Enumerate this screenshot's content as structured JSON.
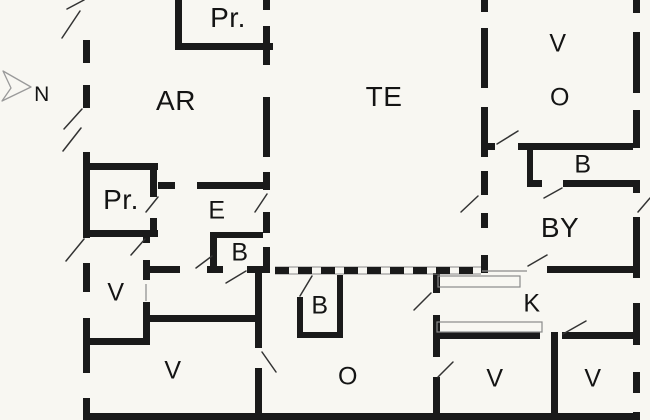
{
  "title": "Floor plan",
  "compass": {
    "label": "N"
  },
  "colors": {
    "wall": "#1a1a1a",
    "background": "#f8f7f2",
    "door_line": "#333333",
    "thin_line": "#8a8a8a",
    "compass_outline": "#9a9a9a"
  },
  "rooms": [
    {
      "id": "pr-north",
      "label": "Pr."
    },
    {
      "id": "ar",
      "label": "AR"
    },
    {
      "id": "te",
      "label": "TE"
    },
    {
      "id": "v-northeast",
      "label": "V"
    },
    {
      "id": "o-northeast",
      "label": "O"
    },
    {
      "id": "b-northeast",
      "label": "B"
    },
    {
      "id": "pr-west",
      "label": "Pr."
    },
    {
      "id": "e-hall",
      "label": "E"
    },
    {
      "id": "b-hall",
      "label": "B"
    },
    {
      "id": "by",
      "label": "BY"
    },
    {
      "id": "v-west",
      "label": "V"
    },
    {
      "id": "b-center",
      "label": "B"
    },
    {
      "id": "v-southwest",
      "label": "V"
    },
    {
      "id": "o-south",
      "label": "O"
    },
    {
      "id": "k-kitchen",
      "label": "K"
    },
    {
      "id": "v-south-1",
      "label": "V"
    },
    {
      "id": "v-south-2",
      "label": "V"
    }
  ]
}
